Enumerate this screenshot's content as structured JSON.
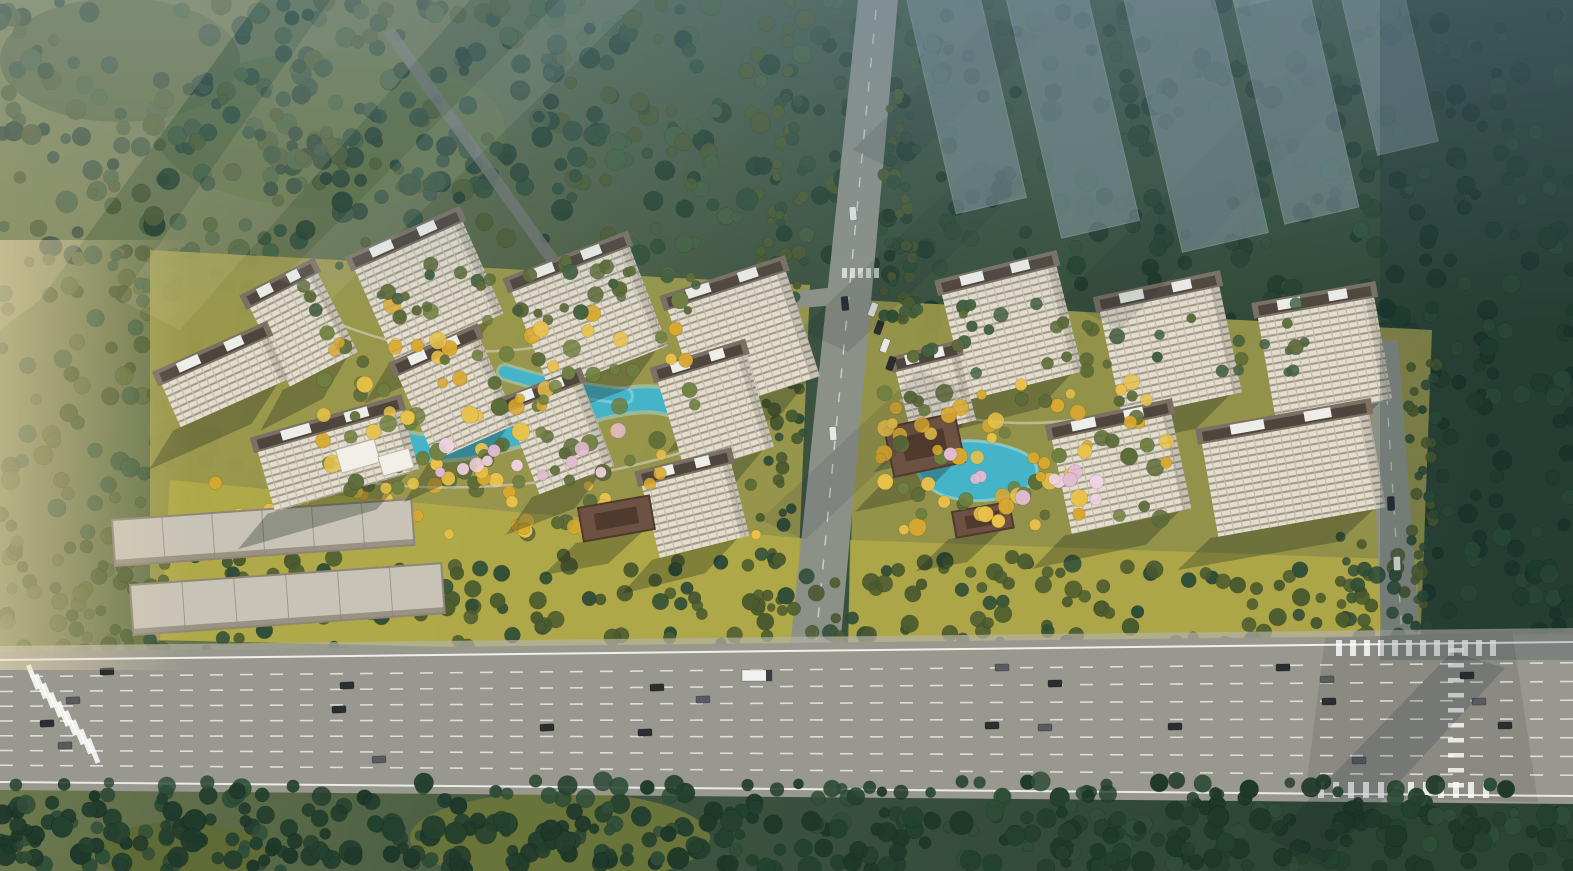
{
  "scene": {
    "type": "aerial-architectural-rendering",
    "description": "Bird's-eye rendering of a two-cluster residential development with cream tower blocks around landscaped courtyards and turquoise ponds, surrounded by forest, a central access road, translucent future-phase towers at top right, and a wide multi-lane highway across the foreground",
    "clusters": 2,
    "towers_west_cluster": 10,
    "towers_east_cluster": 7,
    "ghost_phase_towers": 5,
    "warehouses": 2,
    "highway_lanes": 8
  },
  "colors": {
    "ground_w": "#7c8551",
    "ground_m": "#3c5340",
    "ground_e": "#2c4434",
    "forest_dark": "#24402e",
    "forest_mid": "#2f4e38",
    "forest_light": "#43603f",
    "forest_deep": "#1e382a",
    "olive": "#5d6b38",
    "olive_dark": "#4a5a30",
    "belt": "#4c5c2e",
    "golden": "#d9a92f",
    "golden_light": "#e9c24a",
    "courtyard_green": "#6f8040",
    "blossom": "#e3bcd4",
    "blossom2": "#f0d3e2",
    "lawn": "#a09c4c",
    "lawn_bright": "#b3ab48",
    "pool": "#45b4c9",
    "pool_light": "#9fdde8",
    "road": "#8c9188",
    "road_dark": "#6f7570",
    "highway": "#98988f",
    "highway_dark": "#8a8a83",
    "sidewalk": "#b5b2a6",
    "lane_line": "#ffffff",
    "facade": "#ded9c9",
    "facade_stripe": "#9a9183",
    "roof_parapet": "#7b7063",
    "roof_inner": "#4e463d",
    "penthouse": "#edeee9",
    "pavilion": "#6d5243",
    "pavilion_dark": "#4f3a2d",
    "warehouse": "#c7c3b6",
    "warehouse_edge": "#8f8677",
    "ghost": "#a3b4c1",
    "ghost_cap": "#cddae2",
    "shadow": "#16231c",
    "car_dark": "#2b2e31",
    "car_gray": "#585c60",
    "car_white": "#e8e9e6",
    "truck": "#f2f3f0",
    "haze_warm": "#f0ddb0",
    "haze_blue": "#6e8ca0"
  }
}
